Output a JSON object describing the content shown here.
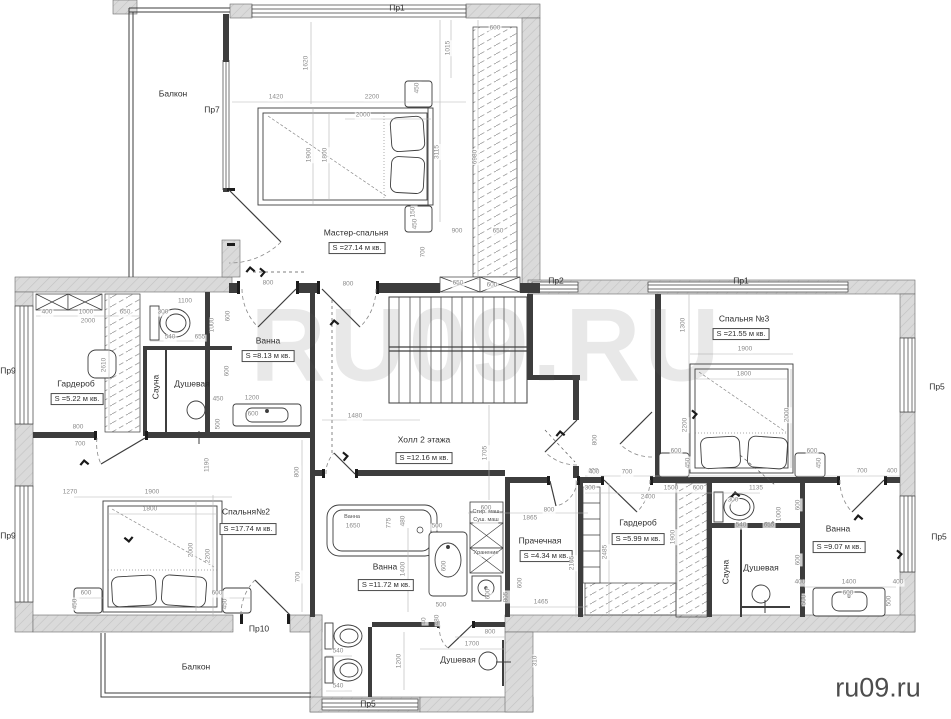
{
  "watermarks": {
    "center": "RU09.RU",
    "corner": "ru09.ru"
  },
  "colors": {
    "wall_fill": "#dadada",
    "wall_hatch": "#c2c2c2",
    "line": "#3d3d3d",
    "dim_text": "#8a8a8a",
    "watermark_center": "rgba(90,90,90,0.14)",
    "watermark_corner": "#4d4d4d"
  },
  "labels": {
    "rooms": [
      [
        "Балкон",
        173,
        94
      ],
      [
        "Мастер-спальня",
        356,
        233
      ],
      [
        "Гардероб",
        76,
        384
      ],
      [
        "Душевая",
        192,
        384
      ],
      [
        "Ванна",
        268,
        341
      ],
      [
        "Холл 2 этажа",
        424,
        440
      ],
      [
        "Спальня №3",
        744,
        319
      ],
      [
        "Спальня№2",
        246,
        512
      ],
      [
        "Ванна",
        385,
        567
      ],
      [
        "Прачечная",
        540,
        541
      ],
      [
        "Гардероб",
        638,
        523
      ],
      [
        "Душевая",
        761,
        568
      ],
      [
        "Ванна",
        838,
        529
      ],
      [
        "Душевая",
        458,
        660
      ],
      [
        "Балкон",
        196,
        667
      ],
      [
        "Сауна",
        156,
        387,
        1
      ],
      [
        "Сауна",
        726,
        572,
        1
      ]
    ],
    "areas": [
      [
        "S =27.14 м кв.",
        357,
        248
      ],
      [
        "S =5.22 м кв.",
        77,
        399
      ],
      [
        "S =8.13 м кв.",
        268,
        356
      ],
      [
        "S =12.16 м кв.",
        424,
        458
      ],
      [
        "S =21.55 м кв.",
        741,
        334
      ],
      [
        "S =17.74 м кв.",
        248,
        529
      ],
      [
        "S =11.72 м кв.",
        386,
        585
      ],
      [
        "S =4.34 м кв.",
        546,
        556
      ],
      [
        "S =5.99 м кв.",
        638,
        539
      ],
      [
        "S =9.07 м кв.",
        839,
        547
      ]
    ],
    "windows": [
      [
        "Пр1",
        397,
        8
      ],
      [
        "Пр7",
        212,
        110
      ],
      [
        "Пр2",
        556,
        281
      ],
      [
        "Пр1",
        741,
        281
      ],
      [
        "Пр5",
        937,
        387
      ],
      [
        "Пр5",
        939,
        537
      ],
      [
        "Пр9",
        8,
        371
      ],
      [
        "Пр9",
        8,
        536
      ],
      [
        "Пр10",
        259,
        629
      ],
      [
        "Пр5",
        368,
        704
      ]
    ],
    "small": [
      [
        "Стир. маш",
        486,
        513
      ],
      [
        "Суш. маш",
        486,
        521
      ],
      [
        "Хранение",
        486,
        554
      ],
      [
        "Ванна",
        352,
        518
      ]
    ],
    "dims": [
      [
        "1420",
        276,
        98
      ],
      [
        "2200",
        372,
        98
      ],
      [
        "2000",
        363,
        116
      ],
      [
        "600",
        495,
        29
      ],
      [
        "900",
        457,
        232
      ],
      [
        "650",
        498,
        232
      ],
      [
        "800",
        268,
        284
      ],
      [
        "800",
        348,
        285
      ],
      [
        "650",
        458,
        284
      ],
      [
        "600",
        492,
        286
      ],
      [
        "1620",
        307,
        63,
        1
      ],
      [
        "1015",
        449,
        48,
        1
      ],
      [
        "1900",
        310,
        155,
        1
      ],
      [
        "1800",
        326,
        155,
        1
      ],
      [
        "450",
        418,
        88,
        1
      ],
      [
        "3115",
        438,
        152,
        1
      ],
      [
        "6980",
        476,
        157,
        1
      ],
      [
        "150",
        414,
        212,
        1
      ],
      [
        "450",
        416,
        224,
        1
      ],
      [
        "700",
        424,
        252,
        1
      ],
      [
        "400",
        47,
        313
      ],
      [
        "1000",
        86,
        313
      ],
      [
        "2000",
        88,
        322
      ],
      [
        "650",
        125,
        313
      ],
      [
        "300",
        163,
        313
      ],
      [
        "1100",
        185,
        302
      ],
      [
        "540",
        170,
        338
      ],
      [
        "655",
        200,
        338
      ],
      [
        "800",
        78,
        428
      ],
      [
        "700",
        80,
        445
      ],
      [
        "450",
        218,
        400
      ],
      [
        "1200",
        252,
        399
      ],
      [
        "600",
        253,
        415
      ],
      [
        "1000",
        213,
        325,
        1
      ],
      [
        "600",
        229,
        316,
        1
      ],
      [
        "600",
        228,
        371,
        1
      ],
      [
        "2610",
        105,
        365,
        1
      ],
      [
        "500",
        219,
        424,
        1
      ],
      [
        "1480",
        355,
        417
      ],
      [
        "1705",
        486,
        453,
        1
      ],
      [
        "800",
        596,
        440,
        1
      ],
      [
        "400",
        593,
        472
      ],
      [
        "1190",
        208,
        465,
        1
      ],
      [
        "1270",
        70,
        493
      ],
      [
        "1900",
        152,
        493
      ],
      [
        "1800",
        150,
        510
      ],
      [
        "2000",
        192,
        550,
        1
      ],
      [
        "2200",
        209,
        556,
        1
      ],
      [
        "600",
        86,
        594
      ],
      [
        "450",
        76,
        604,
        1
      ],
      [
        "600",
        217,
        594
      ],
      [
        "450",
        226,
        604,
        1
      ],
      [
        "800",
        298,
        472,
        1
      ],
      [
        "700",
        299,
        577,
        1
      ],
      [
        "1650",
        353,
        527
      ],
      [
        "775",
        390,
        523,
        1
      ],
      [
        "480",
        404,
        521,
        1
      ],
      [
        "500",
        437,
        527
      ],
      [
        "1400",
        404,
        569,
        1
      ],
      [
        "600",
        445,
        566,
        1
      ],
      [
        "500",
        441,
        606
      ],
      [
        "40",
        425,
        621,
        1
      ],
      [
        "480",
        438,
        620,
        1
      ],
      [
        "600",
        486,
        509
      ],
      [
        "800",
        549,
        511
      ],
      [
        "1865",
        530,
        519
      ],
      [
        "805",
        507,
        597,
        1
      ],
      [
        "600",
        521,
        583,
        1
      ],
      [
        "600",
        489,
        594,
        1
      ],
      [
        "1465",
        541,
        603
      ],
      [
        "2105",
        573,
        563,
        1
      ],
      [
        "540",
        338,
        652
      ],
      [
        "540",
        338,
        687
      ],
      [
        "800",
        490,
        633
      ],
      [
        "1700",
        472,
        645
      ],
      [
        "1200",
        400,
        661,
        1
      ],
      [
        "310",
        536,
        661,
        1
      ],
      [
        "400",
        594,
        473
      ],
      [
        "700",
        627,
        473
      ],
      [
        "300",
        590,
        489
      ],
      [
        "1500",
        671,
        489
      ],
      [
        "2400",
        648,
        498
      ],
      [
        "600",
        698,
        489
      ],
      [
        "1900",
        674,
        537,
        1
      ],
      [
        "2485",
        606,
        552,
        1
      ],
      [
        "1135",
        756,
        489
      ],
      [
        "300",
        733,
        501
      ],
      [
        "540",
        741,
        526
      ],
      [
        "655",
        769,
        526
      ],
      [
        "1000",
        780,
        514,
        1
      ],
      [
        "600",
        799,
        505,
        1
      ],
      [
        "600",
        799,
        560,
        1
      ],
      [
        "400",
        800,
        583
      ],
      [
        "1400",
        849,
        583
      ],
      [
        "400",
        898,
        583
      ],
      [
        "500",
        805,
        600,
        1
      ],
      [
        "500",
        890,
        601,
        1
      ],
      [
        "600",
        848,
        594
      ],
      [
        "1300",
        684,
        325,
        1
      ],
      [
        "1900",
        745,
        350
      ],
      [
        "1800",
        744,
        375
      ],
      [
        "2200",
        686,
        425,
        1
      ],
      [
        "2000",
        788,
        415,
        1
      ],
      [
        "600",
        676,
        452
      ],
      [
        "450",
        689,
        463,
        1
      ],
      [
        "600",
        812,
        452
      ],
      [
        "450",
        820,
        463,
        1
      ],
      [
        "700",
        862,
        472
      ],
      [
        "400",
        892,
        472
      ]
    ]
  }
}
